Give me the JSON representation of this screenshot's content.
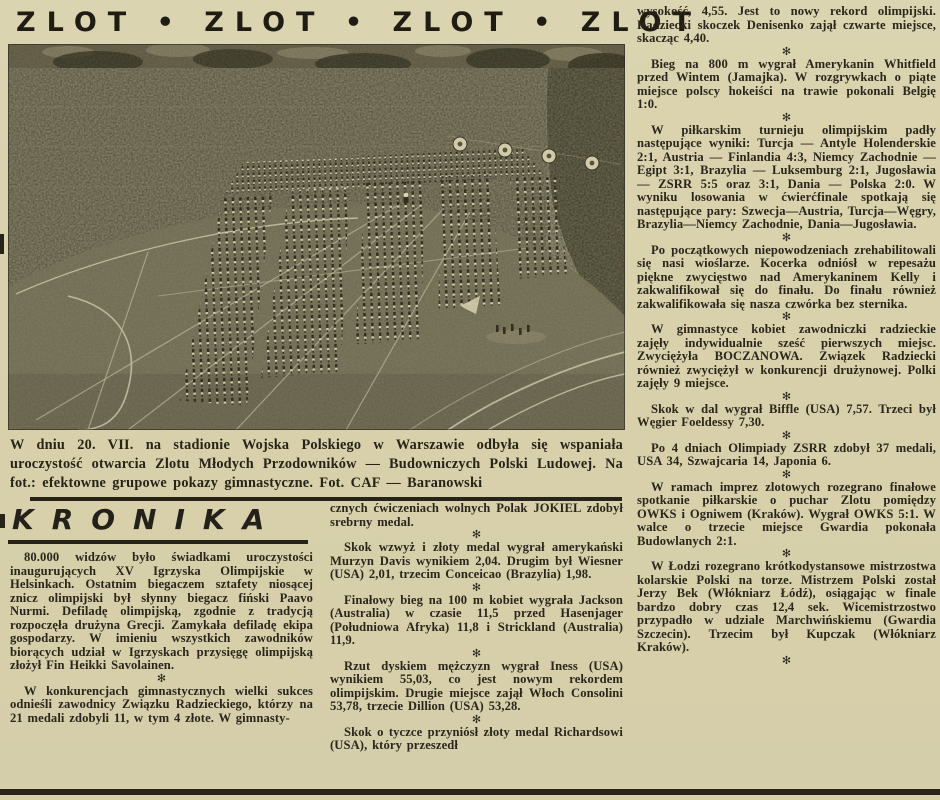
{
  "theme": {
    "paper": "#d9d2ae",
    "ink": "#2a261b",
    "rule": "#26231a",
    "photo_field": "#6e6a52",
    "photo_crowd": "#49452f",
    "photo_trees": "#34311e",
    "photo_highlight": "#d6cfad"
  },
  "masthead": {
    "text": "ZLOT • ZLOT • ZLOT • ZLOT"
  },
  "photo": {
    "caption": "W dniu 20. VII. na stadionie Wojska Polskiego w Warszawie odbyła się wspaniała uroczystość otwarcia Zlotu Młodych Przodowników — Budowniczych Polski Ludowej. Na fot.: efektowne grupowe pokazy gimnastyczne. Fot. CAF — Baranowski"
  },
  "section": {
    "title": "KRONIKA",
    "separator_glyph": "✻"
  },
  "columns": {
    "left": [
      "80.000 widzów było świadkami uroczystości inaugurujących XV Igrzyska Olimpijskie w Helsinkach. Ostatnim biegaczem sztafety niosącej znicz olimpijski był słynny biegacz fiński Paavo Nurmi. Defiladę olimpijską, zgodnie z tradycją rozpoczęła drużyna Grecji. Zamykała defiladę ekipa gospodarzy. W imieniu wszystkich zawodników biorących udział w Igrzyskach przysięgę olimpijską złożył Fin Heikki Savolainen.",
      "W konkurencjach gimnastycznych wielki sukces odnieśli zawodnicy Związku Radzieckiego, którzy na 21 medali zdobyli 11, w tym 4 złote. W gimnasty-"
    ],
    "middle": [
      "cznych ćwiczeniach wolnych Polak JOKIEL zdobył srebrny medal.",
      "Skok wzwyż i złoty medal wygrał amerykański Murzyn Davis wynikiem 2,04. Drugim był Wiesner (USA) 2,01, trzecim Conceicao (Brazylia) 1,98.",
      "Finałowy bieg na 100 m kobiet wygrała Jackson (Australia) w czasie 11,5 przed Hasenjager (Południowa Afryka) 11,8 i Strickland (Australia) 11,9.",
      "Rzut dyskiem mężczyzn wygrał Iness (USA) wynikiem 55,03, co jest nowym rekordem olimpijskim. Drugie miejsce zajął Włoch Consolini 53,78, trzecie Dillion (USA) 53,28.",
      "Skok o tyczce przyniósł złoty medal Richardsowi (USA), który przeszedł"
    ],
    "right": [
      "wysokość, 4,55. Jest to nowy rekord olimpijski. Radziecki skoczek Denisenko zajął czwarte miejsce, skacząc 4,40.",
      "Bieg na 800 m wygrał Amerykanin Whitfield przed Wintem (Jamajka). W rozgrywkach o piąte miejsce polscy hokeiści na trawie pokonali Belgię 1:0.",
      "W piłkarskim turnieju olimpijskim padły następujące wyniki: Turcja — Antyle Holenderskie 2:1, Austria — Finlandia 4:3, Niemcy Zachodnie — Egipt 3:1, Brazylia — Luksemburg 2:1, Jugosławia — ZSRR 5:5 oraz 3:1, Dania — Polska 2:0. W wyniku losowania w ćwierćfinale spotkają się następujące pary: Szwecja—Austria, Turcja—Węgry, Brazylia—Niemcy Zachodnie, Dania—Jugosławia.",
      "Po początkowych niepowodzeniach zrehabilitowali się nasi wioślarze. Kocerka odniósł w repesażu piękne zwycięstwo nad Amerykaninem Kelly i zakwalifikował się do finału. Do finału również zakwalifikowała się nasza czwórka bez sternika.",
      "W gimnastyce kobiet zawodniczki radzieckie zajęły indywidualnie sześć pierwszych miejsc. Zwyciężyła BOCZANOWA. Związek Radziecki również zwyciężył w konkurencji drużynowej. Polki zajęły 9 miejsce.",
      "Skok w dal wygrał Biffle (USA) 7,57. Trzeci był Węgier Foeldessy 7,30.",
      "Po 4 dniach Olimpiady ZSRR zdobył 37 medali, USA 34, Szwajcaria 14, Japonia 6.",
      "W ramach imprez zlotowych rozegrano finałowe spotkanie piłkarskie o puchar Zlotu pomiędzy OWKS i Ogniwem (Kraków). Wygrał OWKS 5:1. W walce o trzecie miejsce Gwardia pokonała Budowlanych 2:1.",
      "W Łodzi rozegrano krótkodystansowe mistrzostwa kolarskie Polski na torze. Mistrzem Polski został Jerzy Bek (Włókniarz Łódź), osiągając w finale bardzo dobry czas 12,4 sek. Wicemistrzostwo przypadło w udziale Marchwińskiemu (Gwardia Szczecin). Trzecim był Kupczak (Włókniarz Kraków)."
    ]
  }
}
